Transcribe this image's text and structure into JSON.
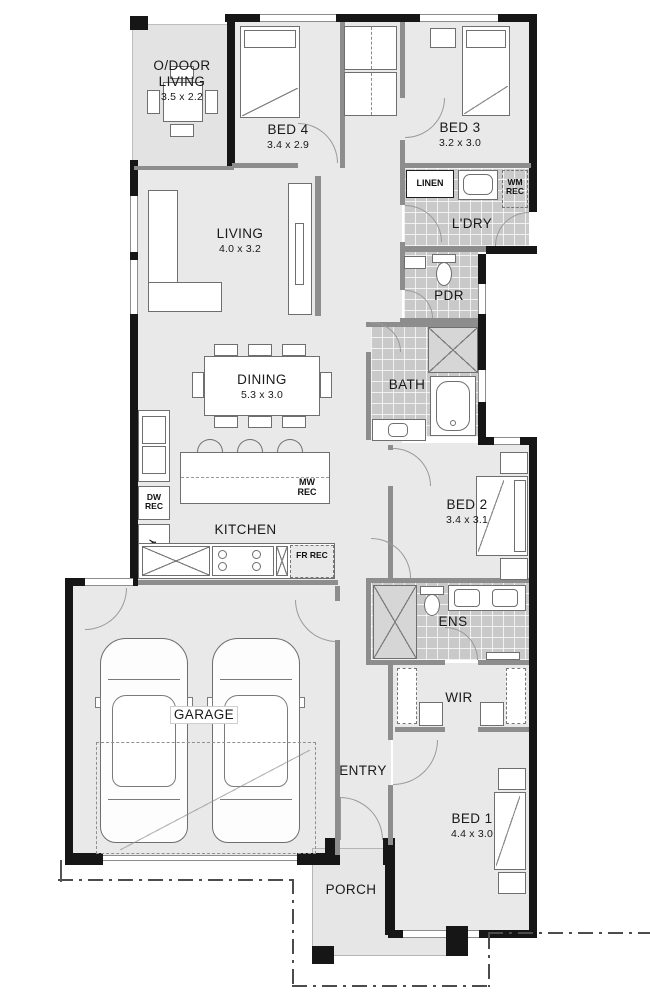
{
  "title": "single-storey-home-floor-plan",
  "colors": {
    "wall": "#161616",
    "floor": "#e9e9e9",
    "tile": "#c9c9c9",
    "alfresco": "#e3e3e3",
    "interior_wall": "#8d8d8d",
    "text": "#191919",
    "background": "#ffffff"
  },
  "rooms": {
    "odoor": {
      "name": "O/DOOR LIVING",
      "dims": "3.5 x 2.2"
    },
    "bed4": {
      "name": "BED 4",
      "dims": "3.4 x 2.9"
    },
    "bed3": {
      "name": "BED 3",
      "dims": "3.2 x 3.0"
    },
    "ldry": {
      "name": "L'DRY"
    },
    "living": {
      "name": "LIVING",
      "dims": "4.0 x 3.2"
    },
    "pdr": {
      "name": "PDR"
    },
    "bath": {
      "name": "BATH"
    },
    "dining": {
      "name": "DINING",
      "dims": "5.3 x 3.0"
    },
    "kitchen": {
      "name": "KITCHEN"
    },
    "bed2": {
      "name": "BED 2",
      "dims": "3.4 x 3.1"
    },
    "ens": {
      "name": "ENS"
    },
    "wir": {
      "name": "WIR"
    },
    "garage": {
      "name": "GARAGE"
    },
    "entry": {
      "name": "ENTRY"
    },
    "bed1": {
      "name": "BED 1",
      "dims": "4.4 x 3.0"
    },
    "porch": {
      "name": "PORCH"
    }
  },
  "fixtures": {
    "linen": "LINEN",
    "wm_rec": "WM REC",
    "dw_rec": "DW REC",
    "pty": "PTY",
    "mw_rec": "MW REC",
    "fr_rec": "FR REC"
  }
}
